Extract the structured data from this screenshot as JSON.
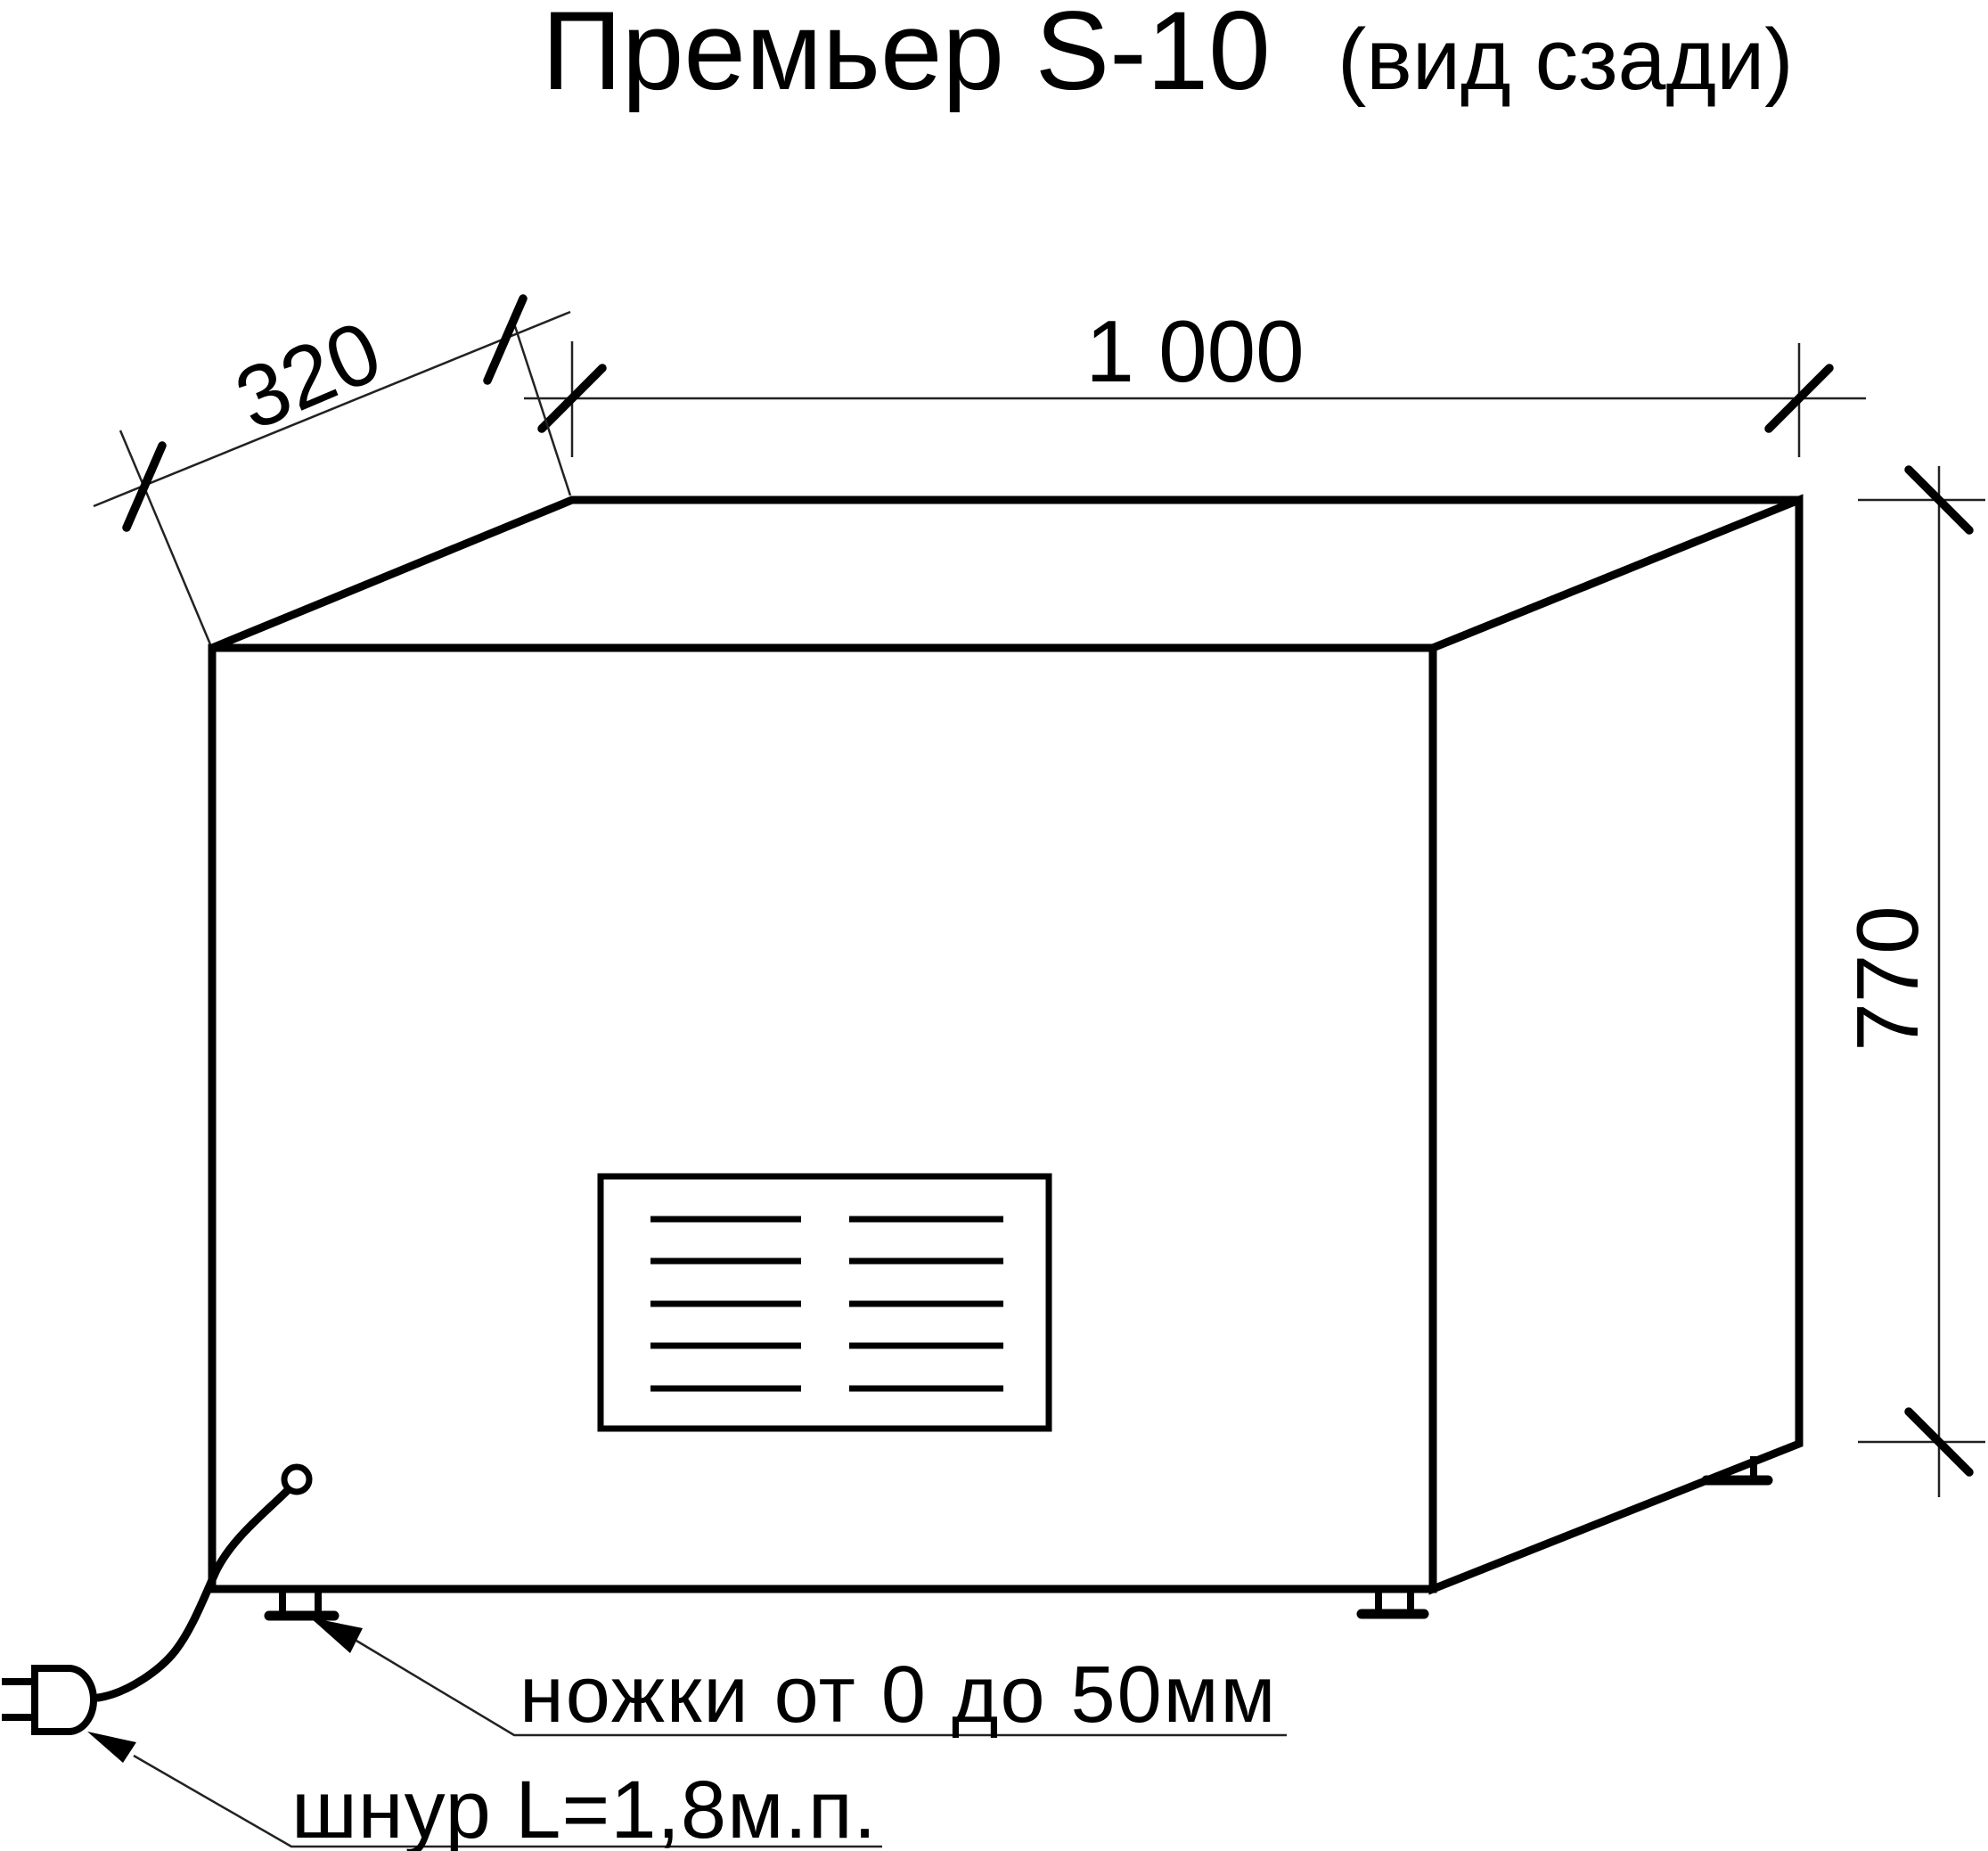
{
  "title": {
    "main": "Премьер S-10",
    "suffix": "(вид сзади)"
  },
  "dimensions": {
    "depth": {
      "label": "320",
      "value_mm": 320,
      "orientation": "diagonal-top-left"
    },
    "width": {
      "label": "1 000",
      "value_mm": 1000,
      "orientation": "horizontal-top"
    },
    "height": {
      "label": "770",
      "value_mm": 770,
      "orientation": "vertical-right"
    }
  },
  "annotations": {
    "legs_note": "ножки от 0 до 50мм",
    "cord_note": "шнур L=1,8м.п."
  },
  "figure": {
    "type": "technical-drawing",
    "view": "rear",
    "object": "cabinet-box",
    "features": [
      "ventilation-grille",
      "adjustable-legs",
      "power-cord-with-plug"
    ]
  },
  "colors": {
    "line": "#000000",
    "thin_line": "#222222",
    "background": "#ffffff"
  }
}
